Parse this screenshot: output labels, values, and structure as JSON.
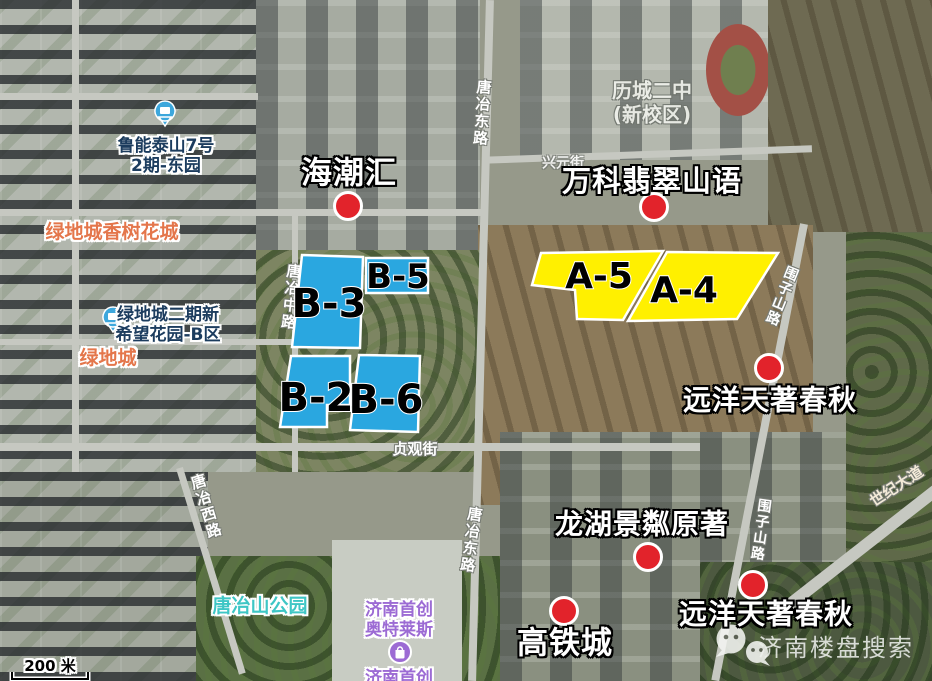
{
  "colors": {
    "parcel_blue": "#2aa7e0",
    "parcel_yellow": "#fff000",
    "marker_red": "#e2232b",
    "poi_pin_blue": "#3da7dc",
    "outlet_purple": "#9c6bd4"
  },
  "parcels": {
    "b3": "B-3",
    "b5": "B-5",
    "b2": "B-2",
    "b6": "B-6",
    "a5": "A-5",
    "a4": "A-4"
  },
  "projects": {
    "haichaohui": "海潮汇",
    "vanke_feicui": "万科翡翠山语",
    "yuanyang_right": "远洋天著春秋",
    "longhu_jinglin": "龙湖景粼原著",
    "yuanyang_bottom": "远洋天著春秋",
    "gaotiecheng": "高铁城"
  },
  "pois": {
    "luneng_line1": "鲁能泰山7号",
    "luneng_line2": "2期-东园",
    "lvdi_xiangshu": "绿地城香树花城",
    "lvdi_erqi_line1": "绿地城二期新",
    "lvdi_erqi_line2": "希望花园-B区",
    "lvdicheng": "绿地城",
    "tangyeshan_park": "唐冶山公园",
    "shouchuang_line1": "济南首创",
    "shouchuang_line2": "奥特莱斯",
    "shouchuang_bottom": "济南首创",
    "licheng_line1": "历城二中",
    "licheng_line2": "(新校区)"
  },
  "roads": {
    "tangye_east_top": "唐冶东路",
    "tangye_mid": "唐冶中路",
    "tangye_west": "唐冶西路",
    "tangye_east_bottom": "唐冶东路",
    "zhenguan_street": "贞观街",
    "xingyuan_street": "兴元街",
    "weizishan_top": "围子山路",
    "weizishan_mid": "围子山路",
    "shiji_avenue": "世纪大道"
  },
  "scale_bar": {
    "label": "200 米"
  },
  "watermark": {
    "label": "济南楼盘搜索"
  }
}
